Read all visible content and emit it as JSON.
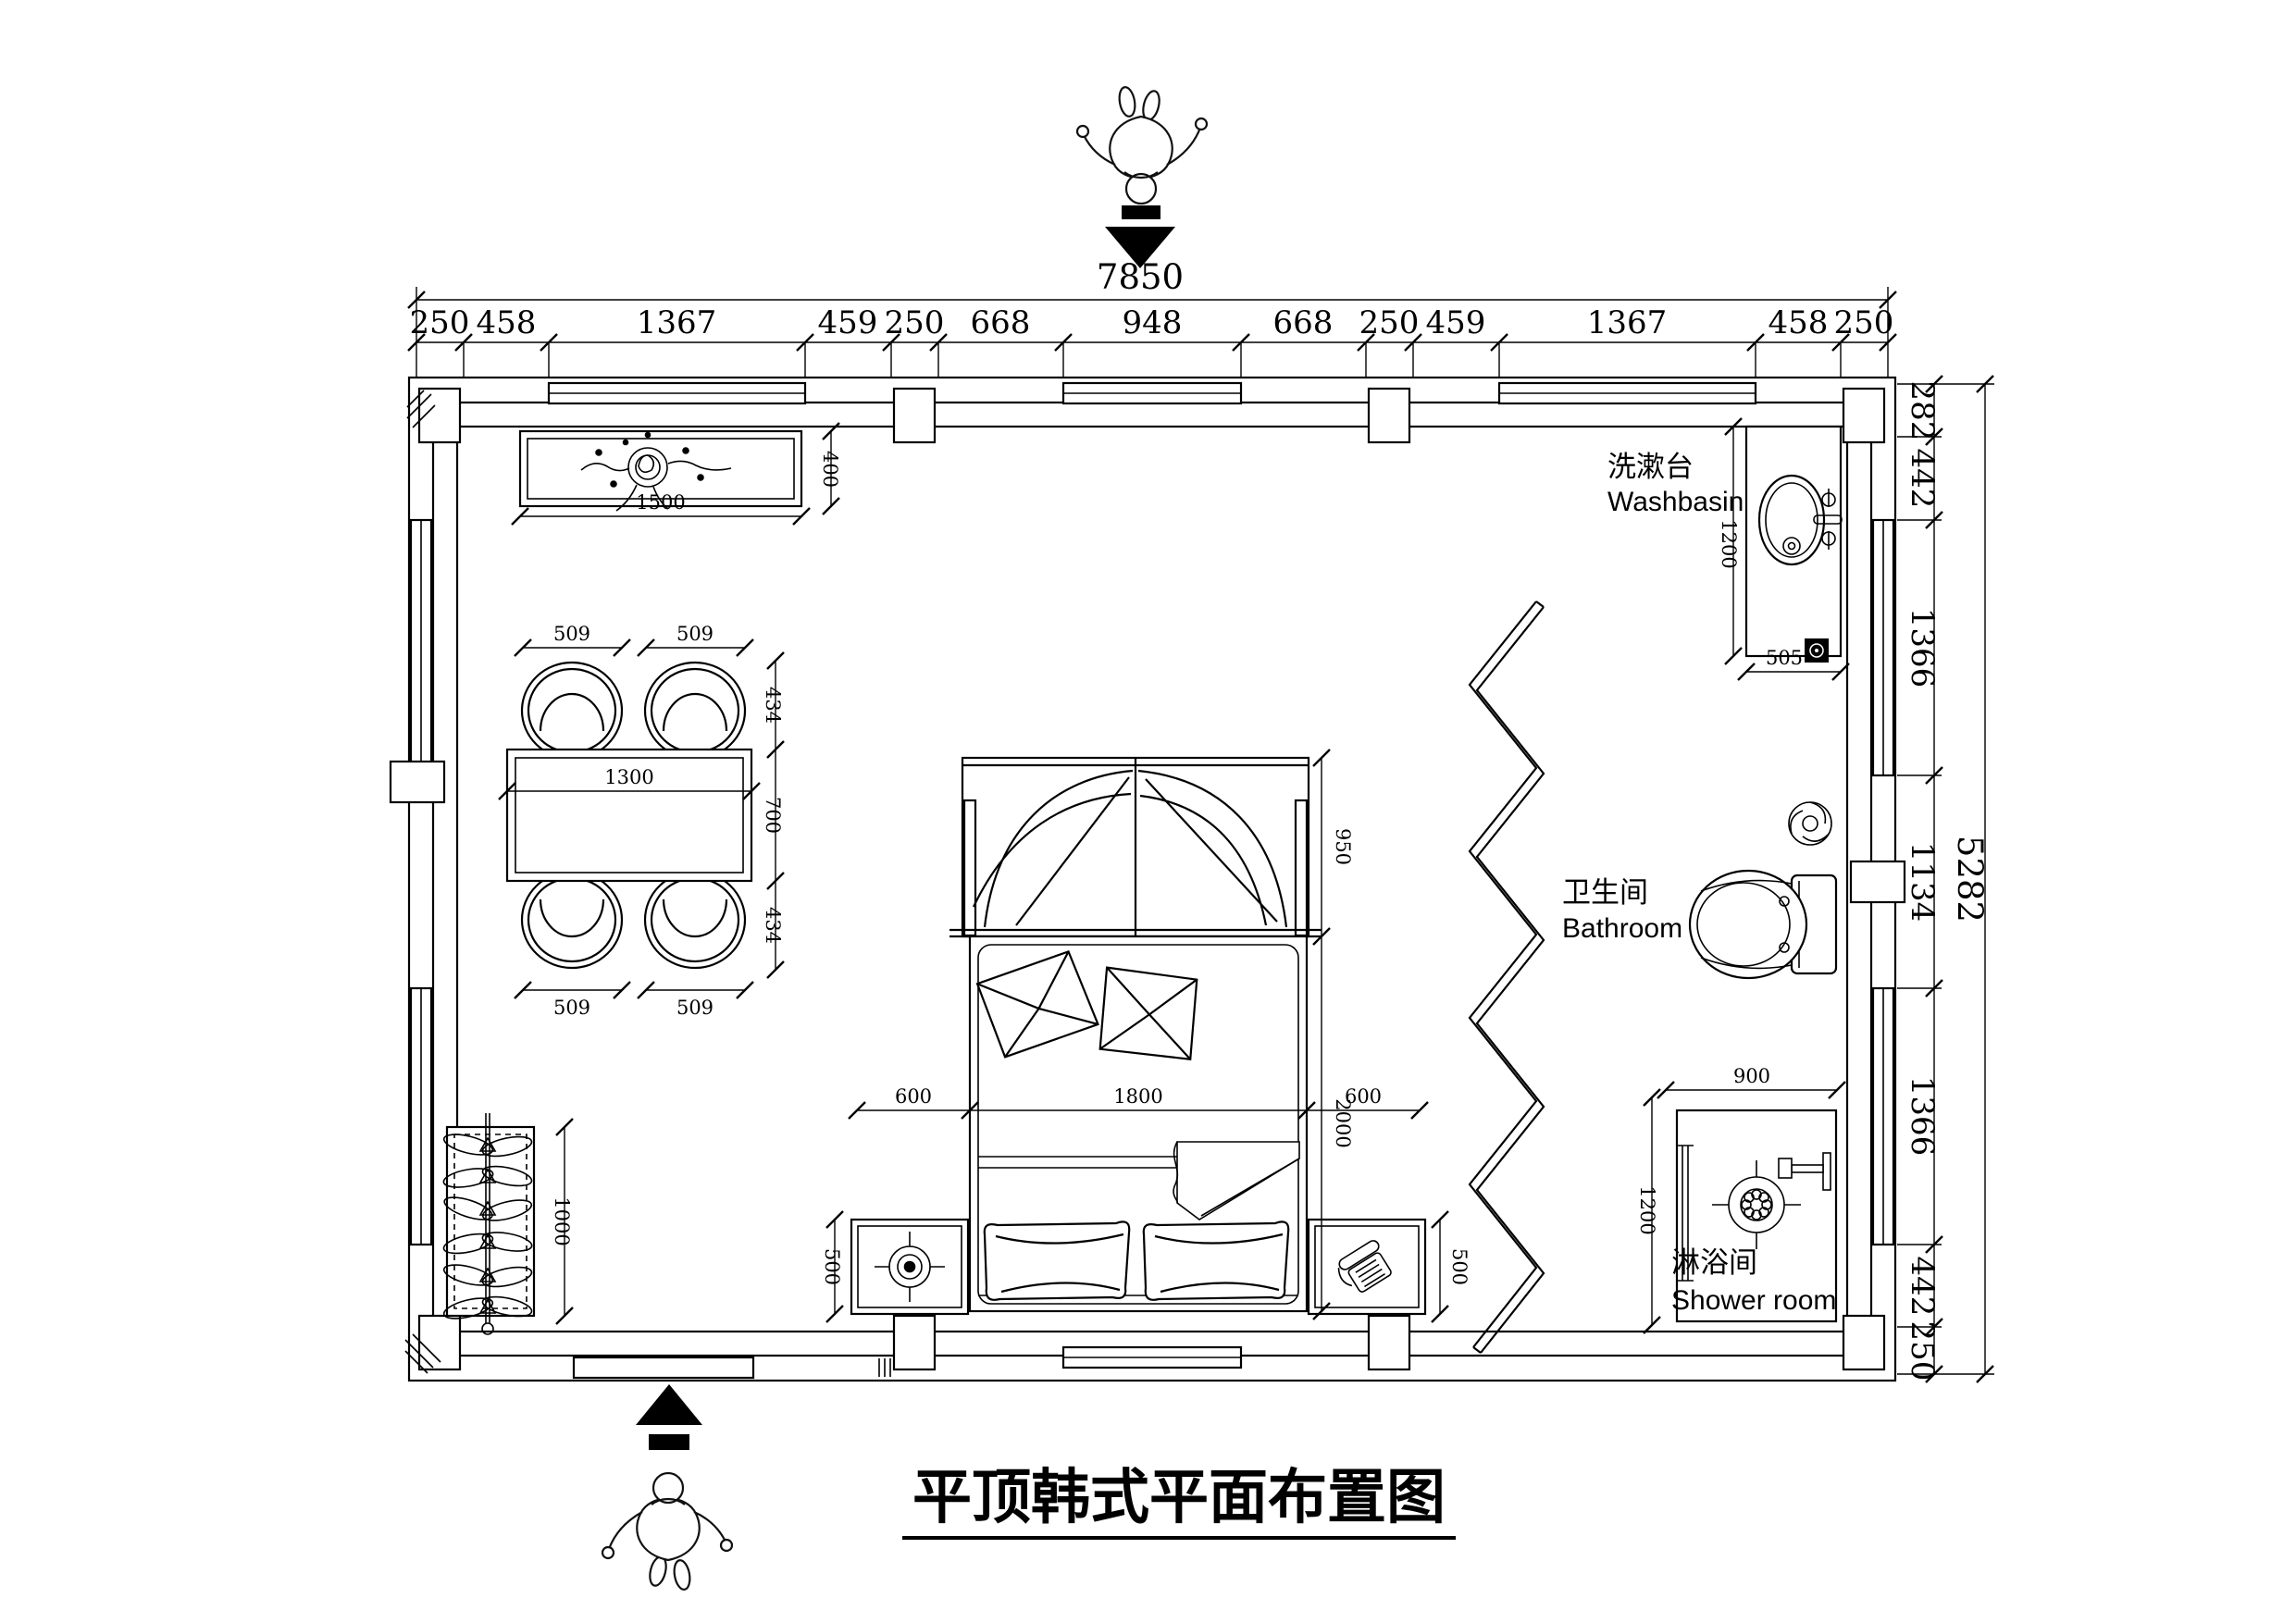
{
  "title": {
    "text": "平顶韩式平面布置图"
  },
  "labels": {
    "washbasin_cn": "洗漱台",
    "washbasin_en": "Washbasin",
    "bathroom_cn": "卫生间",
    "bathroom_en": "Bathroom",
    "shower_cn": "淋浴间",
    "shower_en": "Shower room"
  },
  "dims": {
    "top_total": "7850",
    "top_chain": [
      "250",
      "458",
      "1367",
      "459",
      "250",
      "668",
      "948",
      "668",
      "250",
      "459",
      "1367",
      "458",
      "250"
    ],
    "right_total": "5282",
    "right_chain": [
      "282",
      "442",
      "1366",
      "1134",
      "1366",
      "442",
      "250"
    ],
    "console_w": "1500",
    "console_d": "400",
    "chair_w": [
      "509",
      "509",
      "509",
      "509"
    ],
    "chair_d_top": "434",
    "table_d": "700",
    "chair_d_bottom": "434",
    "table_w": "1300",
    "bed_gap_left": "600",
    "bed_width": "1800",
    "bed_gap_right": "600",
    "bed_length": "2000",
    "bed_head": "950",
    "nightstand_left": "500",
    "nightstand_right": "500",
    "wardrobe_length": "1000",
    "washbasin_length": "1200",
    "washbasin_depth": "505",
    "shower_width": "900",
    "shower_depth": "1200"
  }
}
